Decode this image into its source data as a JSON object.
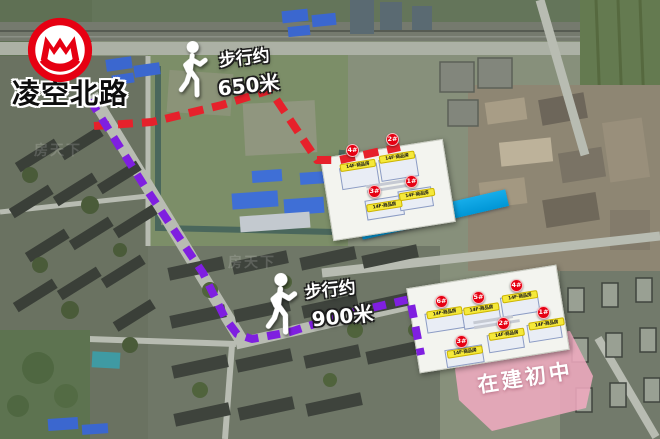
{
  "station": {
    "name": "凌空北路"
  },
  "routes": {
    "red": {
      "prefix": "步行约",
      "distance": "650米",
      "color": "#e6212b"
    },
    "purple": {
      "prefix": "步行约",
      "distance": "900米",
      "color": "#7f1fe0"
    }
  },
  "river": {
    "label": "河道",
    "color": "#00a0e0"
  },
  "school": {
    "label": "在建初中",
    "color": "#efaabf"
  },
  "plans": {
    "north": {
      "buildings": [
        {
          "badge": "4#",
          "label": "14F·商品房"
        },
        {
          "badge": "2#",
          "label": "14F·商品房"
        },
        {
          "badge": "3#",
          "label": "14F·商品房"
        },
        {
          "badge": "1#",
          "label": "14F·商品房"
        }
      ]
    },
    "south": {
      "buildings": [
        {
          "badge": "6#",
          "label": "14F·商品房"
        },
        {
          "badge": "5#",
          "label": "14F·商品房"
        },
        {
          "badge": "4#",
          "label": "14F·商品房"
        },
        {
          "badge": "2#",
          "label": "14F·商品房"
        },
        {
          "badge": "1#",
          "label": "14F·商品房"
        },
        {
          "badge": "3#",
          "label": "14F·商品房"
        }
      ]
    }
  },
  "watermark": {
    "text": "房天下"
  },
  "colors": {
    "metro_red": "#e60012",
    "badge_red": "#e60012",
    "label_yellow": "#f5e93a"
  }
}
